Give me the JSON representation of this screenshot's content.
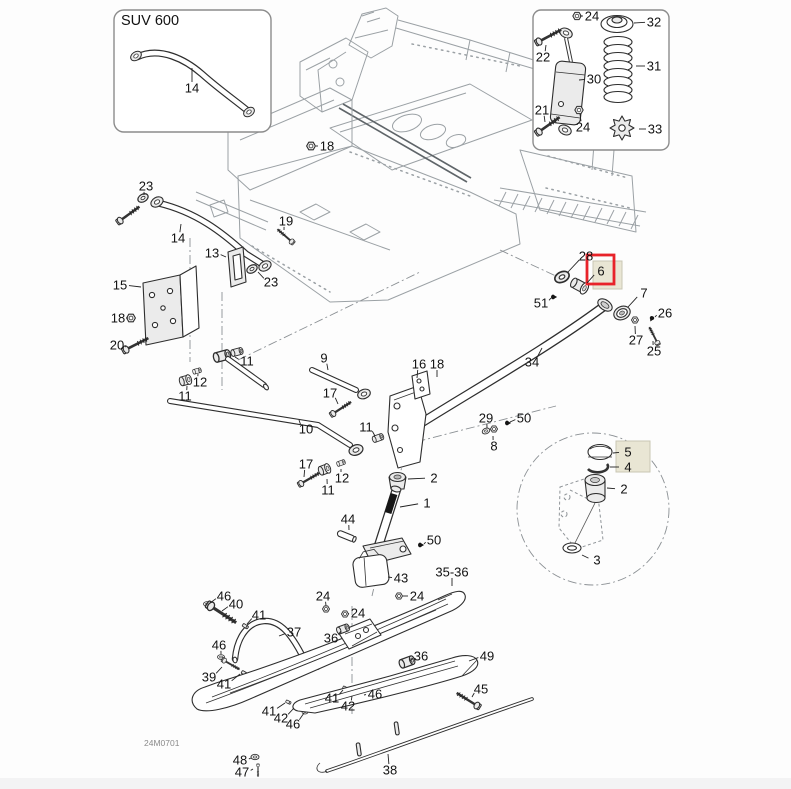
{
  "diagram": {
    "inset_title": "SUV 600",
    "footer_code": "24M0701",
    "colors": {
      "highlight_red": "#e8232a",
      "highlight_beige": "#e9e6d4",
      "chassis_line": "#9ba1a5",
      "part_line": "#2e2e2e"
    },
    "labels": [
      {
        "t": "14",
        "x": 192,
        "y": 88,
        "lx": 192,
        "ly": 68
      },
      {
        "t": "24",
        "x": 592,
        "y": 16,
        "lx": 580,
        "ly": 16
      },
      {
        "t": "32",
        "x": 654,
        "y": 22,
        "lx": 634,
        "ly": 23
      },
      {
        "t": "22",
        "x": 543,
        "y": 57,
        "lx": 546,
        "ly": 45
      },
      {
        "t": "30",
        "x": 594,
        "y": 79,
        "lx": 579,
        "ly": 80
      },
      {
        "t": "31",
        "x": 654,
        "y": 66,
        "lx": 636,
        "ly": 66
      },
      {
        "t": "21",
        "x": 542,
        "y": 110,
        "lx": 545,
        "ly": 122
      },
      {
        "t": "24",
        "x": 583,
        "y": 127,
        "lx": 580,
        "ly": 114
      },
      {
        "t": "33",
        "x": 655,
        "y": 129,
        "lx": 639,
        "ly": 129
      },
      {
        "t": "18",
        "x": 327,
        "y": 146,
        "lx": 316,
        "ly": 146
      },
      {
        "t": "23",
        "x": 146,
        "y": 186,
        "lx": 144,
        "ly": 195
      },
      {
        "t": "19",
        "x": 286,
        "y": 221,
        "lx": 284,
        "ly": 230
      },
      {
        "t": "14",
        "x": 178,
        "y": 238,
        "lx": 181,
        "ly": 224
      },
      {
        "t": "13",
        "x": 212,
        "y": 253,
        "lx": 226,
        "ly": 257
      },
      {
        "t": "23",
        "x": 271,
        "y": 282,
        "lx": 258,
        "ly": 272
      },
      {
        "t": "15",
        "x": 120,
        "y": 285,
        "lx": 141,
        "ly": 287
      },
      {
        "t": "18",
        "x": 118,
        "y": 318,
        "lx": 128,
        "ly": 318
      },
      {
        "t": "20",
        "x": 117,
        "y": 345,
        "lx": 125,
        "ly": 347
      },
      {
        "t": "28",
        "x": 586,
        "y": 256,
        "lx": 568,
        "ly": 272
      },
      {
        "t": "6",
        "x": 601,
        "y": 271,
        "lx": 587,
        "ly": 283
      },
      {
        "t": "51",
        "x": 541,
        "y": 303,
        "lx": 551,
        "ly": 298
      },
      {
        "t": "7",
        "x": 644,
        "y": 293,
        "lx": 628,
        "ly": 307
      },
      {
        "t": "26",
        "x": 665,
        "y": 313,
        "lx": 655,
        "ly": 317
      },
      {
        "t": "27",
        "x": 636,
        "y": 340,
        "lx": 635,
        "ly": 326
      },
      {
        "t": "25",
        "x": 654,
        "y": 351,
        "lx": 653,
        "ly": 341
      },
      {
        "t": "34",
        "x": 532,
        "y": 362,
        "lx": 542,
        "ly": 348
      },
      {
        "t": "9",
        "x": 324,
        "y": 358,
        "lx": 328,
        "ly": 370
      },
      {
        "t": "11",
        "x": 247,
        "y": 361,
        "lx": 235,
        "ly": 357
      },
      {
        "t": "12",
        "x": 200,
        "y": 382,
        "lx": 198,
        "ly": 374
      },
      {
        "t": "11",
        "x": 185,
        "y": 396,
        "lx": 187,
        "ly": 386
      },
      {
        "t": "17",
        "x": 330,
        "y": 393,
        "lx": 338,
        "ly": 404
      },
      {
        "t": "16",
        "x": 419,
        "y": 364,
        "lx": 417,
        "ly": 378
      },
      {
        "t": "18",
        "x": 437,
        "y": 364,
        "lx": 437,
        "ly": 377
      },
      {
        "t": "10",
        "x": 306,
        "y": 429,
        "lx": 299,
        "ly": 420
      },
      {
        "t": "11",
        "x": 366,
        "y": 427,
        "lx": 375,
        "ly": 436
      },
      {
        "t": "29",
        "x": 486,
        "y": 418,
        "lx": 487,
        "ly": 428
      },
      {
        "t": "50",
        "x": 524,
        "y": 418,
        "lx": 510,
        "ly": 422
      },
      {
        "t": "8",
        "x": 494,
        "y": 446,
        "lx": 493,
        "ly": 436
      },
      {
        "t": "17",
        "x": 306,
        "y": 464,
        "lx": 304,
        "ly": 477
      },
      {
        "t": "12",
        "x": 342,
        "y": 478,
        "lx": 341,
        "ly": 469
      },
      {
        "t": "11",
        "x": 328,
        "y": 490,
        "lx": 327,
        "ly": 479
      },
      {
        "t": "2",
        "x": 434,
        "y": 478,
        "lx": 408,
        "ly": 479
      },
      {
        "t": "1",
        "x": 427,
        "y": 503,
        "lx": 400,
        "ly": 507
      },
      {
        "t": "44",
        "x": 348,
        "y": 519,
        "lx": 349,
        "ly": 530
      },
      {
        "t": "50",
        "x": 434,
        "y": 540,
        "lx": 424,
        "ly": 544
      },
      {
        "t": "43",
        "x": 401,
        "y": 578,
        "lx": 388,
        "ly": 577
      },
      {
        "t": "5",
        "x": 628,
        "y": 452,
        "lx": 613,
        "ly": 453
      },
      {
        "t": "4",
        "x": 628,
        "y": 467,
        "lx": 610,
        "ly": 467
      },
      {
        "t": "2",
        "x": 624,
        "y": 489,
        "lx": 607,
        "ly": 488
      },
      {
        "t": "3",
        "x": 597,
        "y": 560,
        "lx": 582,
        "ly": 555
      },
      {
        "t": "35-36",
        "x": 452,
        "y": 572,
        "lx": 452,
        "ly": 586
      },
      {
        "t": "24",
        "x": 323,
        "y": 596,
        "lx": 326,
        "ly": 606
      },
      {
        "t": "24",
        "x": 358,
        "y": 613,
        "lx": 348,
        "ly": 614
      },
      {
        "t": "24",
        "x": 417,
        "y": 596,
        "lx": 403,
        "ly": 596
      },
      {
        "t": "46",
        "x": 224,
        "y": 596,
        "lx": 210,
        "ly": 603
      },
      {
        "t": "40",
        "x": 236,
        "y": 604,
        "lx": 222,
        "ly": 611
      },
      {
        "t": "41",
        "x": 259,
        "y": 615,
        "lx": 247,
        "ly": 624
      },
      {
        "t": "37",
        "x": 294,
        "y": 632,
        "lx": 279,
        "ly": 636
      },
      {
        "t": "46",
        "x": 219,
        "y": 645,
        "lx": 221,
        "ly": 654
      },
      {
        "t": "39",
        "x": 209,
        "y": 677,
        "lx": 222,
        "ly": 667
      },
      {
        "t": "41",
        "x": 224,
        "y": 684,
        "lx": 240,
        "ly": 674
      },
      {
        "t": "36",
        "x": 331,
        "y": 638,
        "lx": 341,
        "ly": 631
      },
      {
        "t": "36",
        "x": 421,
        "y": 656,
        "lx": 410,
        "ly": 661
      },
      {
        "t": "41",
        "x": 332,
        "y": 698,
        "lx": 343,
        "ly": 690
      },
      {
        "t": "42",
        "x": 348,
        "y": 706,
        "lx": 352,
        "ly": 696
      },
      {
        "t": "46",
        "x": 375,
        "y": 694,
        "lx": 364,
        "ly": 695
      },
      {
        "t": "41",
        "x": 269,
        "y": 711,
        "lx": 285,
        "ly": 703
      },
      {
        "t": "42",
        "x": 281,
        "y": 718,
        "lx": 294,
        "ly": 708
      },
      {
        "t": "46",
        "x": 293,
        "y": 724,
        "lx": 304,
        "ly": 713
      },
      {
        "t": "49",
        "x": 487,
        "y": 656,
        "lx": 469,
        "ly": 661
      },
      {
        "t": "45",
        "x": 481,
        "y": 689,
        "lx": 472,
        "ly": 697
      },
      {
        "t": "48",
        "x": 240,
        "y": 760,
        "lx": 251,
        "ly": 758
      },
      {
        "t": "47",
        "x": 242,
        "y": 772,
        "lx": 253,
        "ly": 769
      },
      {
        "t": "38",
        "x": 390,
        "y": 770,
        "lx": 388,
        "ly": 754
      }
    ]
  }
}
